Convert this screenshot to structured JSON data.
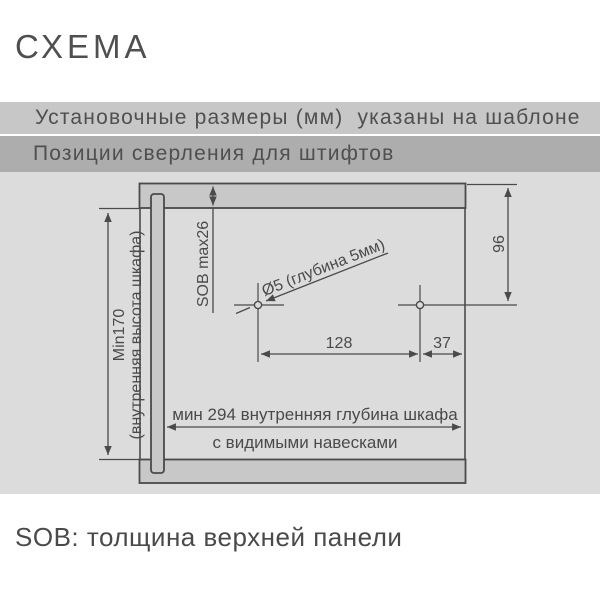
{
  "title": "СХЕМА",
  "bars": {
    "top": "Установочные размеры (мм)  указаны на шаблоне",
    "bottom": "Позиции сверления для штифтов"
  },
  "diagram": {
    "description": "Схема позиций сверления для штифтов на боковине шкафа",
    "height_min_line1": "Min170",
    "height_min_line2": "(внутренняя высота шкафа)",
    "top_panel_thickness": "SOB max26",
    "hole_label": "Ø5 (глубина 5мм)",
    "offset_from_top": "96",
    "distance_between_holes": "128",
    "offset_from_back": "37",
    "depth_label": "мин 294 внутренняя глубина шкафа",
    "depth_note": "с видимыми навесками"
  },
  "footer": "SOB: толщина верхней панели",
  "colors": {
    "bar_top_bg": "#c7c7c7",
    "bar_bottom_bg": "#adadad",
    "diagram_bg": "#dcdcdc",
    "panel_fill": "#c8c8c8",
    "line": "#4a4a4a",
    "text": "#4a4a4a"
  }
}
